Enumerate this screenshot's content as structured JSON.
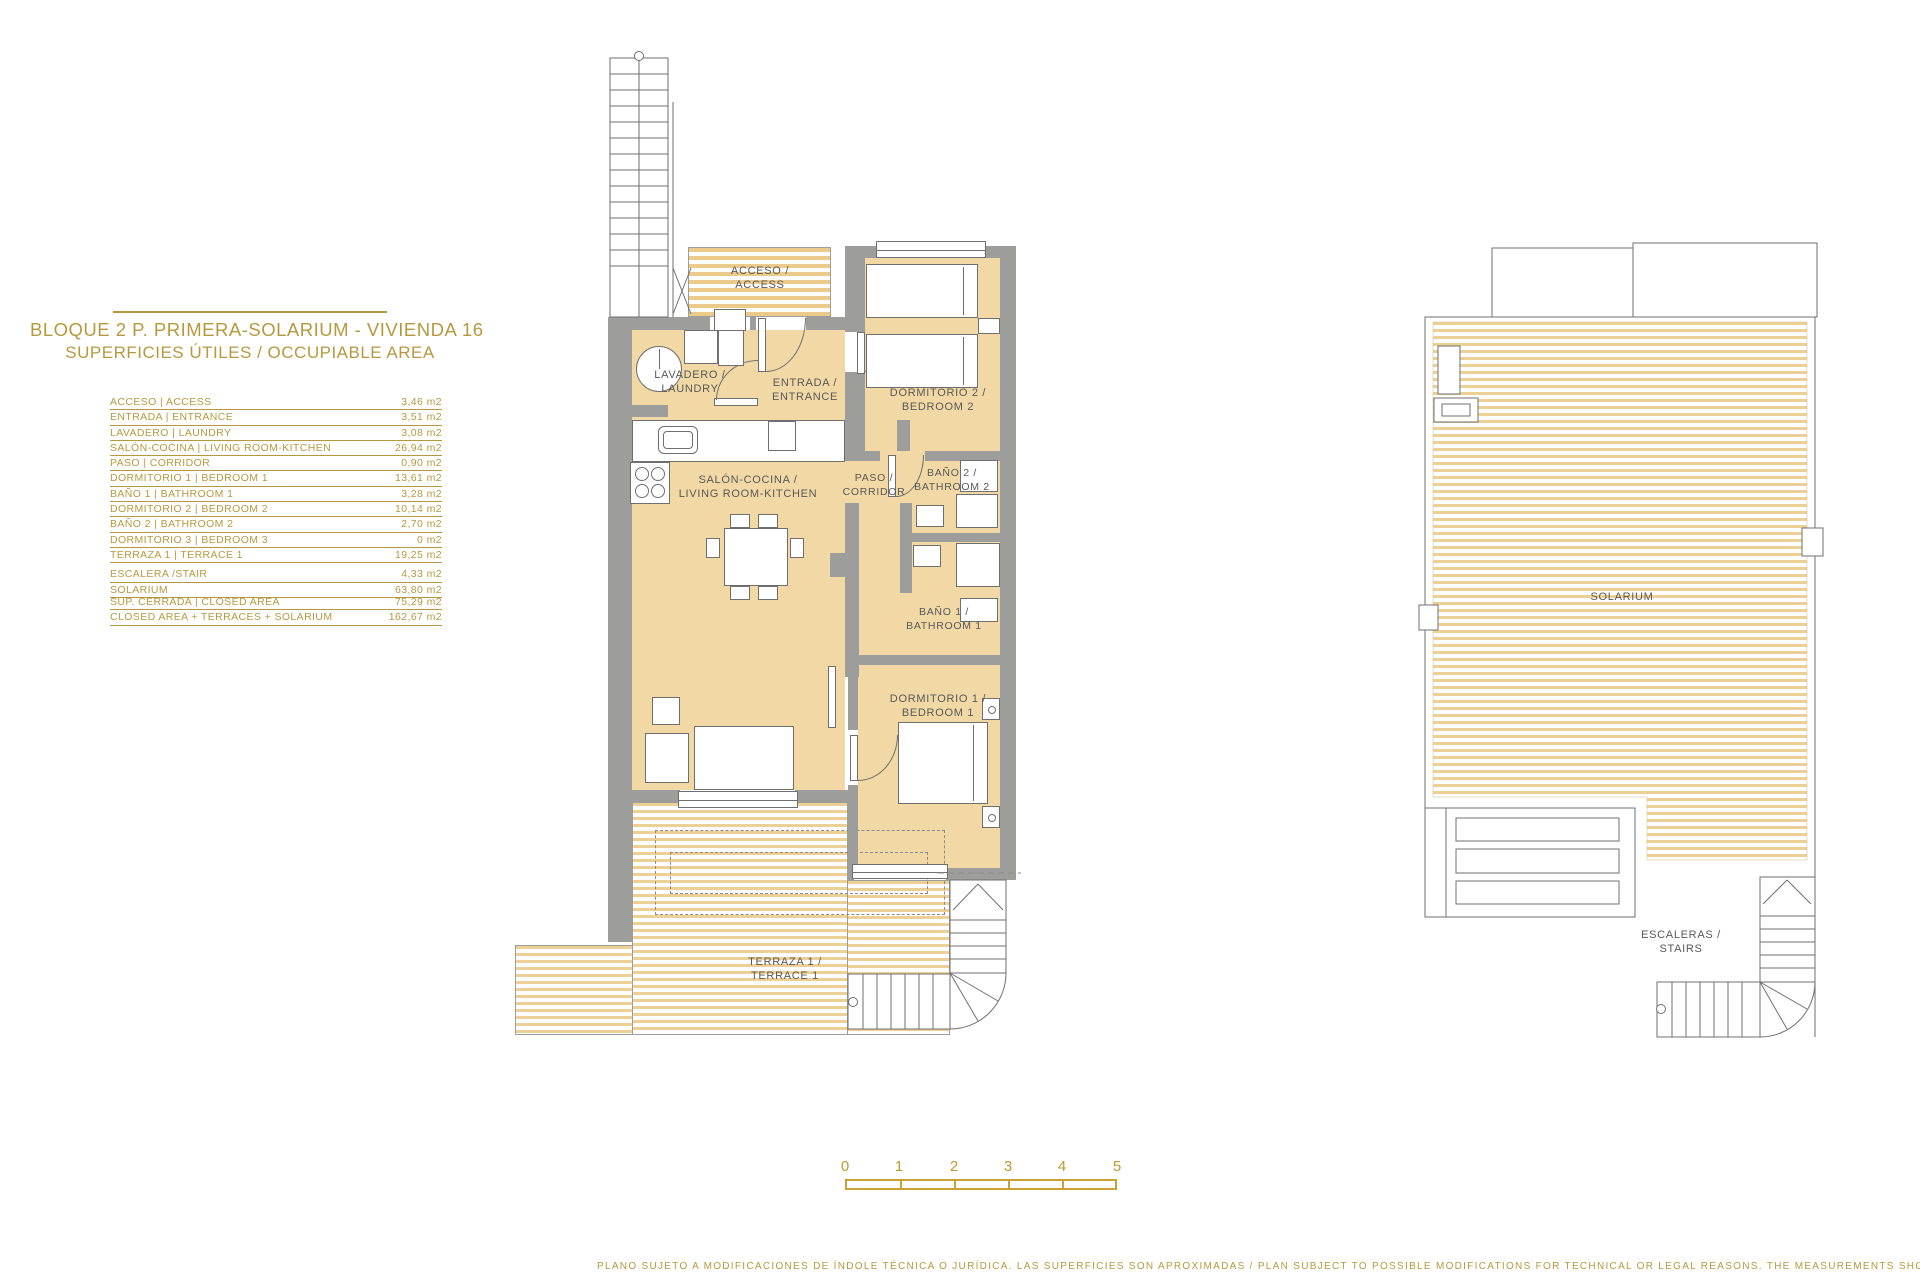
{
  "panel": {
    "title_line1": "BLOQUE 2 P. PRIMERA-SOLARIUM - VIVIENDA 16",
    "title_line2": "SUPERFICIES ÚTILES / OCCUPIABLE AREA",
    "rows": [
      {
        "label": "ACCESO | ACCESS",
        "value": "3,46 m2"
      },
      {
        "label": "ENTRADA | ENTRANCE",
        "value": "3,51 m2"
      },
      {
        "label": "LAVADERO | LAUNDRY",
        "value": "3,08 m2"
      },
      {
        "label": "SALÓN-COCINA | LIVING ROOM-KITCHEN",
        "value": "26,94 m2"
      },
      {
        "label": "PASO | CORRIDOR",
        "value": "0,90 m2"
      },
      {
        "label": "DORMITORIO 1 | BEDROOM 1",
        "value": "13,61 m2"
      },
      {
        "label": "BAÑO 1 | BATHROOM 1",
        "value": "3,28 m2"
      },
      {
        "label": "DORMITORIO 2 | BEDROOM 2",
        "value": "10,14 m2"
      },
      {
        "label": "BAÑO 2 | BATHROOM 2",
        "value": "2,70 m2"
      },
      {
        "label": "DORMITORIO 3 | BEDROOM 3",
        "value": "0 m2"
      },
      {
        "label": "TERRAZA 1 | TERRACE 1",
        "value": "19,25 m2"
      },
      {
        "label": "ESCALERA /STAIR",
        "value": "4,33 m2"
      },
      {
        "label": "SOLARIUM",
        "value": "63,80 m2"
      }
    ],
    "totals": [
      {
        "label": "SUP. CERRADA | CLOSED AREA",
        "value": "75,29 m2"
      },
      {
        "label": "CLOSED AREA + TERRACES + SOLARIUM",
        "value": "162,67 m2"
      }
    ]
  },
  "main_plan": {
    "rooms": {
      "acceso": {
        "l1": "ACCESO /",
        "l2": "ACCESS"
      },
      "lavadero": {
        "l1": "LAVADERO /",
        "l2": "LAUNDRY"
      },
      "entrada": {
        "l1": "ENTRADA /",
        "l2": "ENTRANCE"
      },
      "dormitorio2": {
        "l1": "DORMITORIO 2 /",
        "l2": "BEDROOM 2"
      },
      "salon": {
        "l1": "SALÓN-COCINA /",
        "l2": "LIVING ROOM-KITCHEN"
      },
      "paso": {
        "l1": "PASO /",
        "l2": "CORRIDOR"
      },
      "bano2": {
        "l1": "BAÑO 2 /",
        "l2": "BATHROOM 2"
      },
      "bano1": {
        "l1": "BAÑO 1 /",
        "l2": "BATHROOM 1"
      },
      "dormitorio1": {
        "l1": "DORMITORIO 1 /",
        "l2": "BEDROOM 1"
      },
      "terraza": {
        "l1": "TERRAZA 1 /",
        "l2": "TERRACE 1"
      }
    }
  },
  "solarium_plan": {
    "solarium_label": "SOLARIUM",
    "stairs": {
      "l1": "ESCALERAS /",
      "l2": "STAIRS"
    }
  },
  "scale_bar": {
    "labels": [
      "0",
      "1",
      "2",
      "3",
      "4",
      "5"
    ]
  },
  "footer": {
    "disclaimer": "PLANO SUJETO A MODIFICACIONES DE ÍNDOLE TÉCNICA O JURÍDICA. LAS SUPERFICIES SON APROXIMADAS / PLAN SUBJECT TO POSSIBLE MODIFICATIONS FOR TECHNICAL OR LEGAL REASONS. THE MEASUREMENTS SHOWN ARE APPROXIMATE"
  },
  "colors": {
    "gold": "#B6993F",
    "tan": "#F1D8A4",
    "wall_gray": "#9D9D9C",
    "stripe": "#ECD096",
    "plan_text": "#58585A"
  }
}
